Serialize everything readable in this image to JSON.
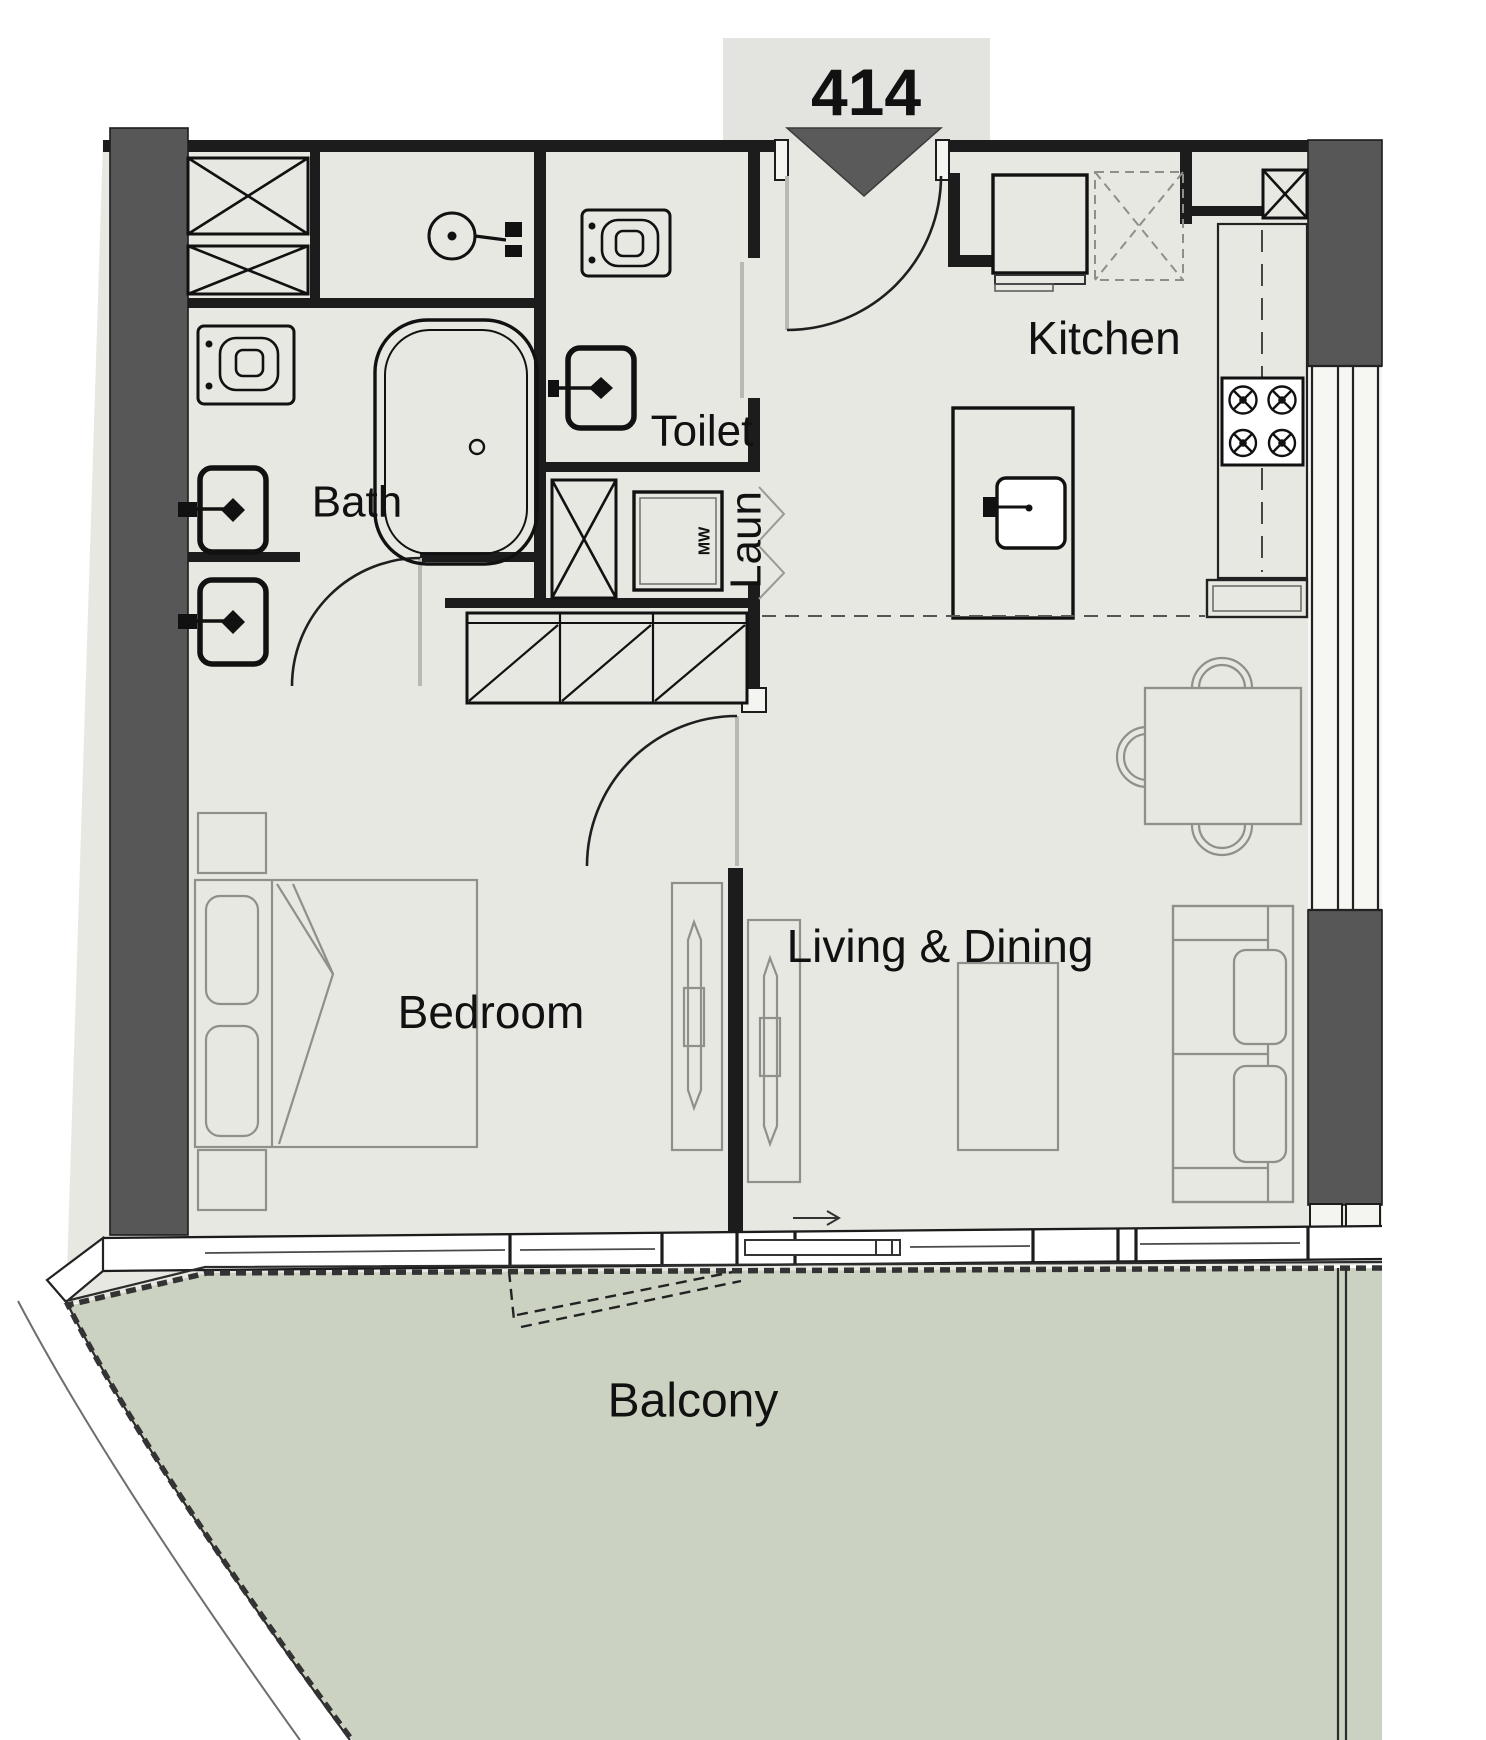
{
  "unit": {
    "number": "414"
  },
  "labels": {
    "kitchen": "Kitchen",
    "toilet": "Toilet",
    "laundry": "Laun",
    "bath": "Bath",
    "bedroom": "Bedroom",
    "living_dining": "Living & Dining",
    "balcony": "Balcony",
    "washer": "MW"
  },
  "colors": {
    "floor": "#e8e8e3",
    "balcony": "#cbd2c1",
    "structural_wall": "#575757",
    "wall_line": "#1c1c1c",
    "fixture_line": "#111111",
    "furniture_line": "#8f9089",
    "label_text": "#111111",
    "unit_box_bg": "#e3e4df",
    "entry_triangle": "#5a5a5a"
  }
}
